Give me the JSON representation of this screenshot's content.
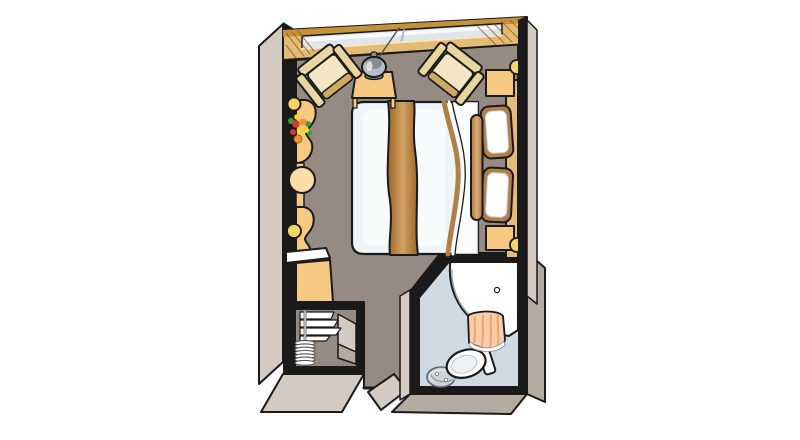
{
  "palette": {
    "background": "#ffffff",
    "outline": "#1a1a1a",
    "floor": "#968b82",
    "wall_face": "#d3cac1",
    "wall_face_dark": "#b5aa9f",
    "wood_light": "#e4bb74",
    "wood_mid": "#c6913c",
    "wood_dark": "#8a5a1e",
    "glass": "#dfe6ea",
    "glass_highlight": "#f8fbfd",
    "cream": "#e9d5a0",
    "cream_dark": "#cfa95c",
    "cream_light": "#f4e6c2",
    "counter": "#f6c983",
    "counter_light": "#fbdda9",
    "lamp_yellow": "#f4d566",
    "metal": "#b9bfc4",
    "metal_dark": "#878e94",
    "duvet": "#eef5f8",
    "duvet_shade": "#d6e5ec",
    "runner_dark": "#9c6426",
    "runner_light": "#d2a164",
    "bolster_dark": "#a9763b",
    "bolster_light": "#d9ae77",
    "tan_wood": "#e2bb7d",
    "pillow_trim": "#b08048",
    "white": "#ffffff",
    "bath_floor": "#cfdae3",
    "curtain": "#f7cdaa",
    "curtain_dark": "#eda26c",
    "drain": "#cdd3d8",
    "leaf_green": "#3f9b35",
    "flower_red": "#d93a2b",
    "flower_orange": "#f09330",
    "flower_yellow": "#f7d431"
  },
  "plan": {
    "kind": "cabin-floor-plan",
    "areas": [
      "sitting-area",
      "bed-area",
      "vanity-area",
      "wardrobe",
      "bathroom",
      "entrance-hall"
    ],
    "objects": [
      "panoramic-window",
      "armchair-left",
      "armchair-right",
      "side-table",
      "pendant-lamp",
      "double-bed",
      "bed-runner",
      "bolster-pillow",
      "pillow",
      "headboard",
      "nightstand-top",
      "nightstand-bottom",
      "wall-sconce-lamp",
      "vanity-counter",
      "flower-bouquet",
      "stool",
      "minibar",
      "cabinet",
      "wardrobe-shelves",
      "hanger-rail",
      "coat-hangers",
      "bathroom-sink",
      "toilet",
      "shower-drain",
      "shower-curtain",
      "door-threshold"
    ]
  }
}
